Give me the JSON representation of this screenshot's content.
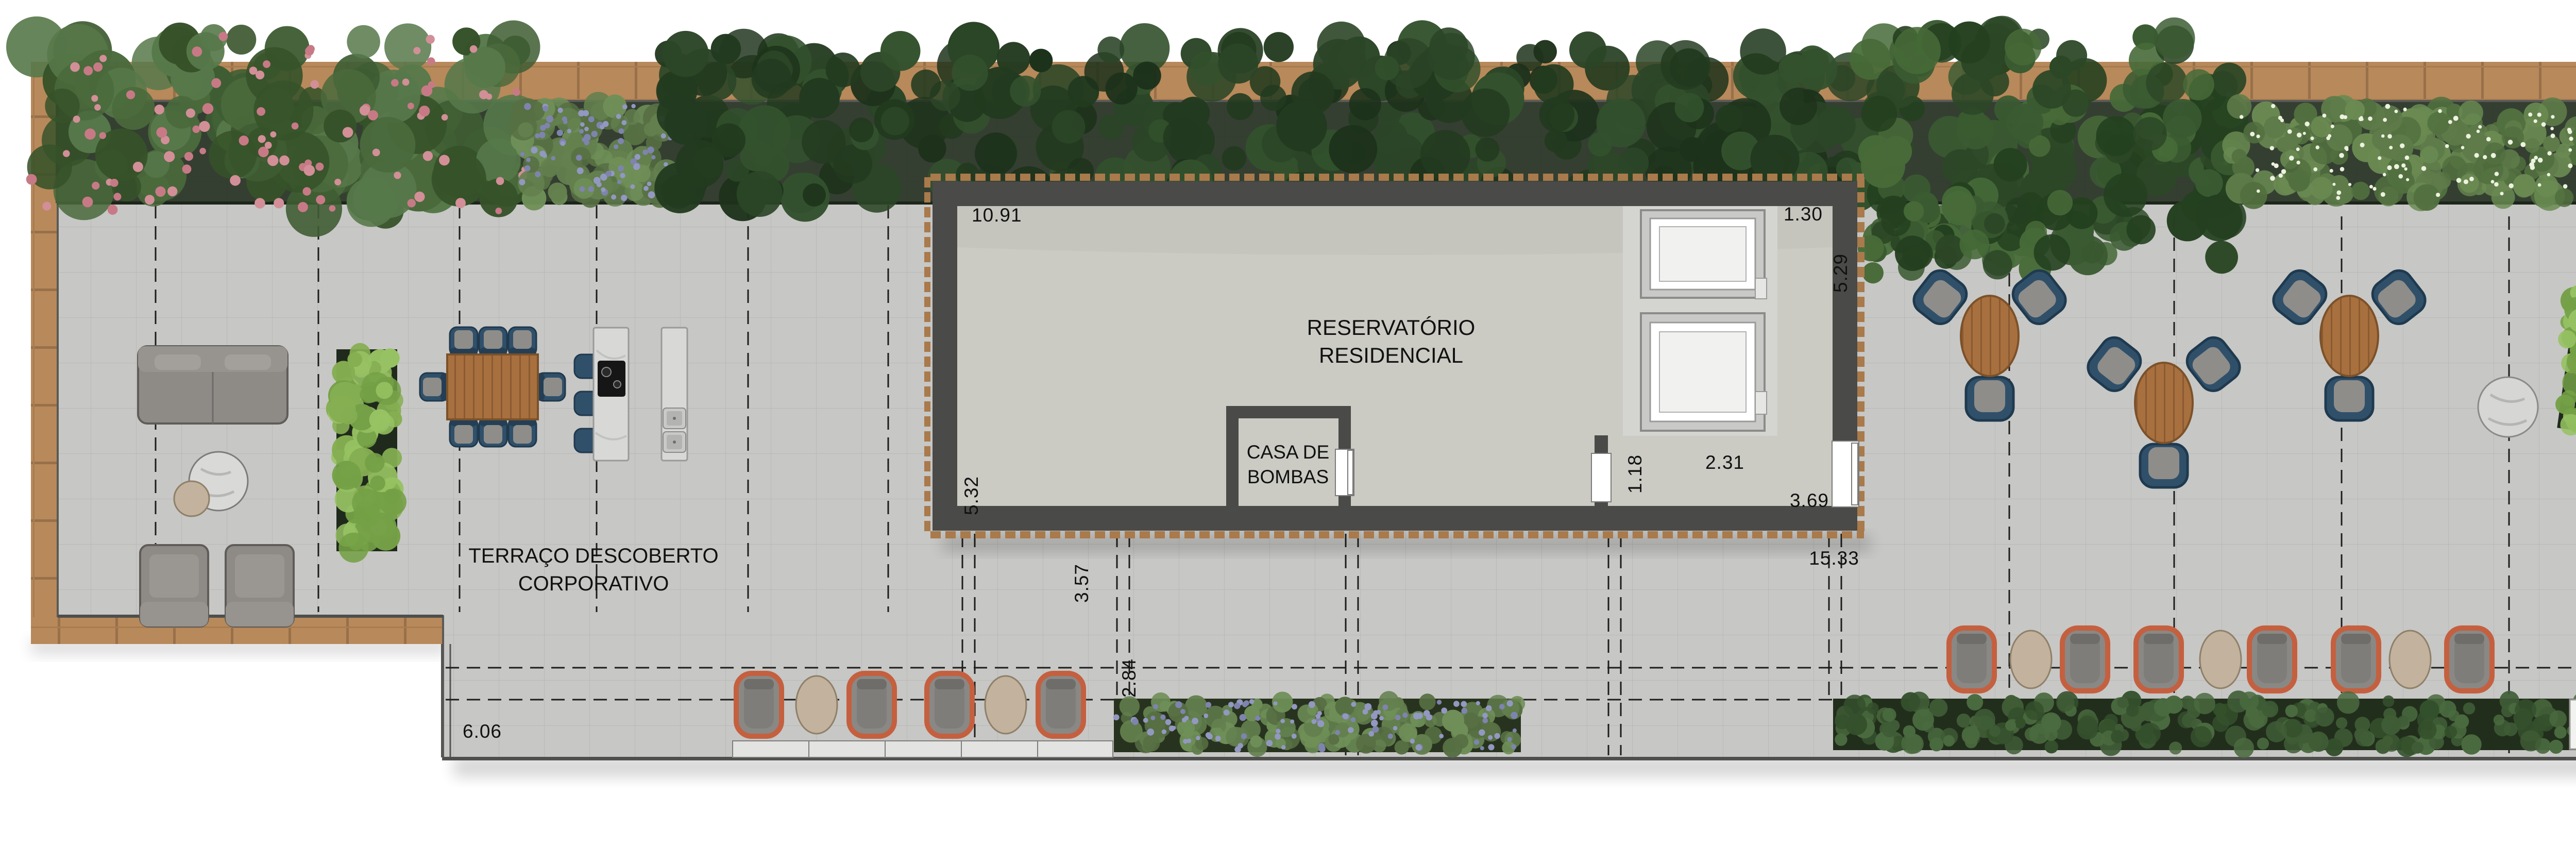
{
  "plan": {
    "type": "rooftop-terrace-floor-plan",
    "labels": {
      "terrace_line1": "TERRAÇO DESCOBERTO",
      "terrace_line2": "CORPORATIVO",
      "reservoir_line1": "RESERVATÓRIO",
      "reservoir_line2": "RESIDENCIAL",
      "pump_house_line1": "CASA DE",
      "pump_house_line2": "BOMBAS"
    },
    "dimensions": {
      "reservoir_width_top": "10.91",
      "reservoir_height_left": "5.32",
      "offset_below_left": "3.57",
      "equipment_bay_width": "1.30",
      "reservoir_height_right": "5.29",
      "pump_door_width": "1.18",
      "pump_corridor_width": "2.31",
      "corridor_depth": "3.69",
      "building_total_width": "15.33",
      "walkway_width": "2.84",
      "terrace_left_depth": "6.06",
      "terrace_right_depth": "8.15"
    },
    "colors": {
      "deck_wood": "#b8895a",
      "terrace_paving": "#c7c7c5",
      "building_wall": "#4a4a48",
      "building_floor": "#cbcbc4",
      "vegetation_dark": "#2b4527",
      "vegetation_bright": "#7da556",
      "hedge_green": "#8cb457",
      "lavender_flower": "#8f95bd",
      "pink_flower": "#d28f97",
      "chair_navy": "#30506a",
      "chair_orange": "#c9654a",
      "furniture_gray": "#8e8a86",
      "marble": "#d8d8d6",
      "table_wood": "#a8703e",
      "dimension_text": "#111111"
    }
  }
}
